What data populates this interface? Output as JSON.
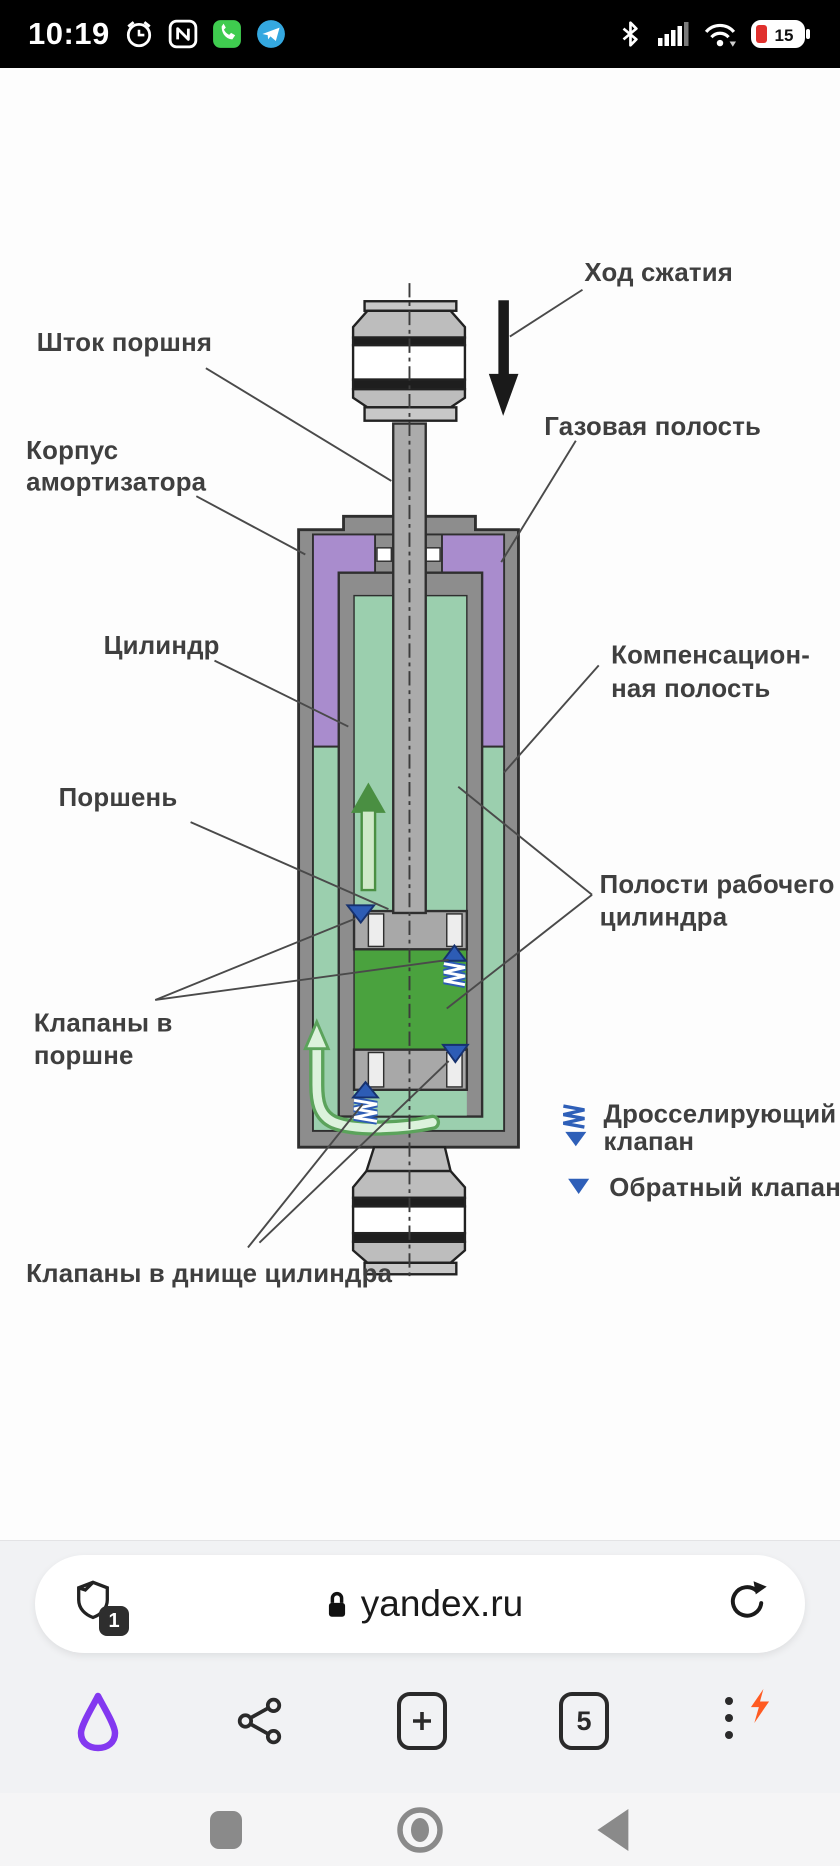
{
  "status_bar": {
    "time": "10:19",
    "battery_percent": "15",
    "left_icons": [
      "alarm-icon",
      "nfc-icon",
      "whatsapp-icon",
      "telegram-icon"
    ],
    "right_icons": [
      "bluetooth-icon",
      "signal-icon",
      "wifi-icon",
      "battery-icon"
    ]
  },
  "diagram": {
    "title_semantic": "twin-tube shock absorber schematic",
    "labels": {
      "hod_szhatiya": "Ход сжатия",
      "shtok_porshnya": "Шток поршня",
      "korpus": [
        "Корпус",
        "амортизатора"
      ],
      "gazovaya_polost": "Газовая полость",
      "cilindr": "Цилиндр",
      "kompensacionnaya": [
        "Компенсацион-",
        "ная полость"
      ],
      "porshen": "Поршень",
      "polosti_rabochego": [
        "Полости рабочего",
        "цилиндра"
      ],
      "klapany_v_porshne": [
        "Клапаны в",
        "поршне"
      ],
      "drosseliruyushchiy": [
        "Дросселирующий",
        "клапан"
      ],
      "obratny_klapan": "Обратный клапан",
      "klapany_v_dnishche": "Клапаны в днище цилиндра"
    },
    "colors": {
      "gas_cavity_purple": "#a98ccd",
      "oil_seafoam_green": "#9bcfae",
      "lower_chamber_green": "#4aa23e",
      "metal_gray": "#8d8d8d",
      "valve_blue": "#2d5cb5",
      "flow_arrow_green": "#4a8f42"
    }
  },
  "browser": {
    "url": "yandex.ru",
    "blocked_count": "1",
    "tab_count": "5",
    "accent_purple": "#8338f0",
    "lightning_orange": "#ff5b22"
  }
}
